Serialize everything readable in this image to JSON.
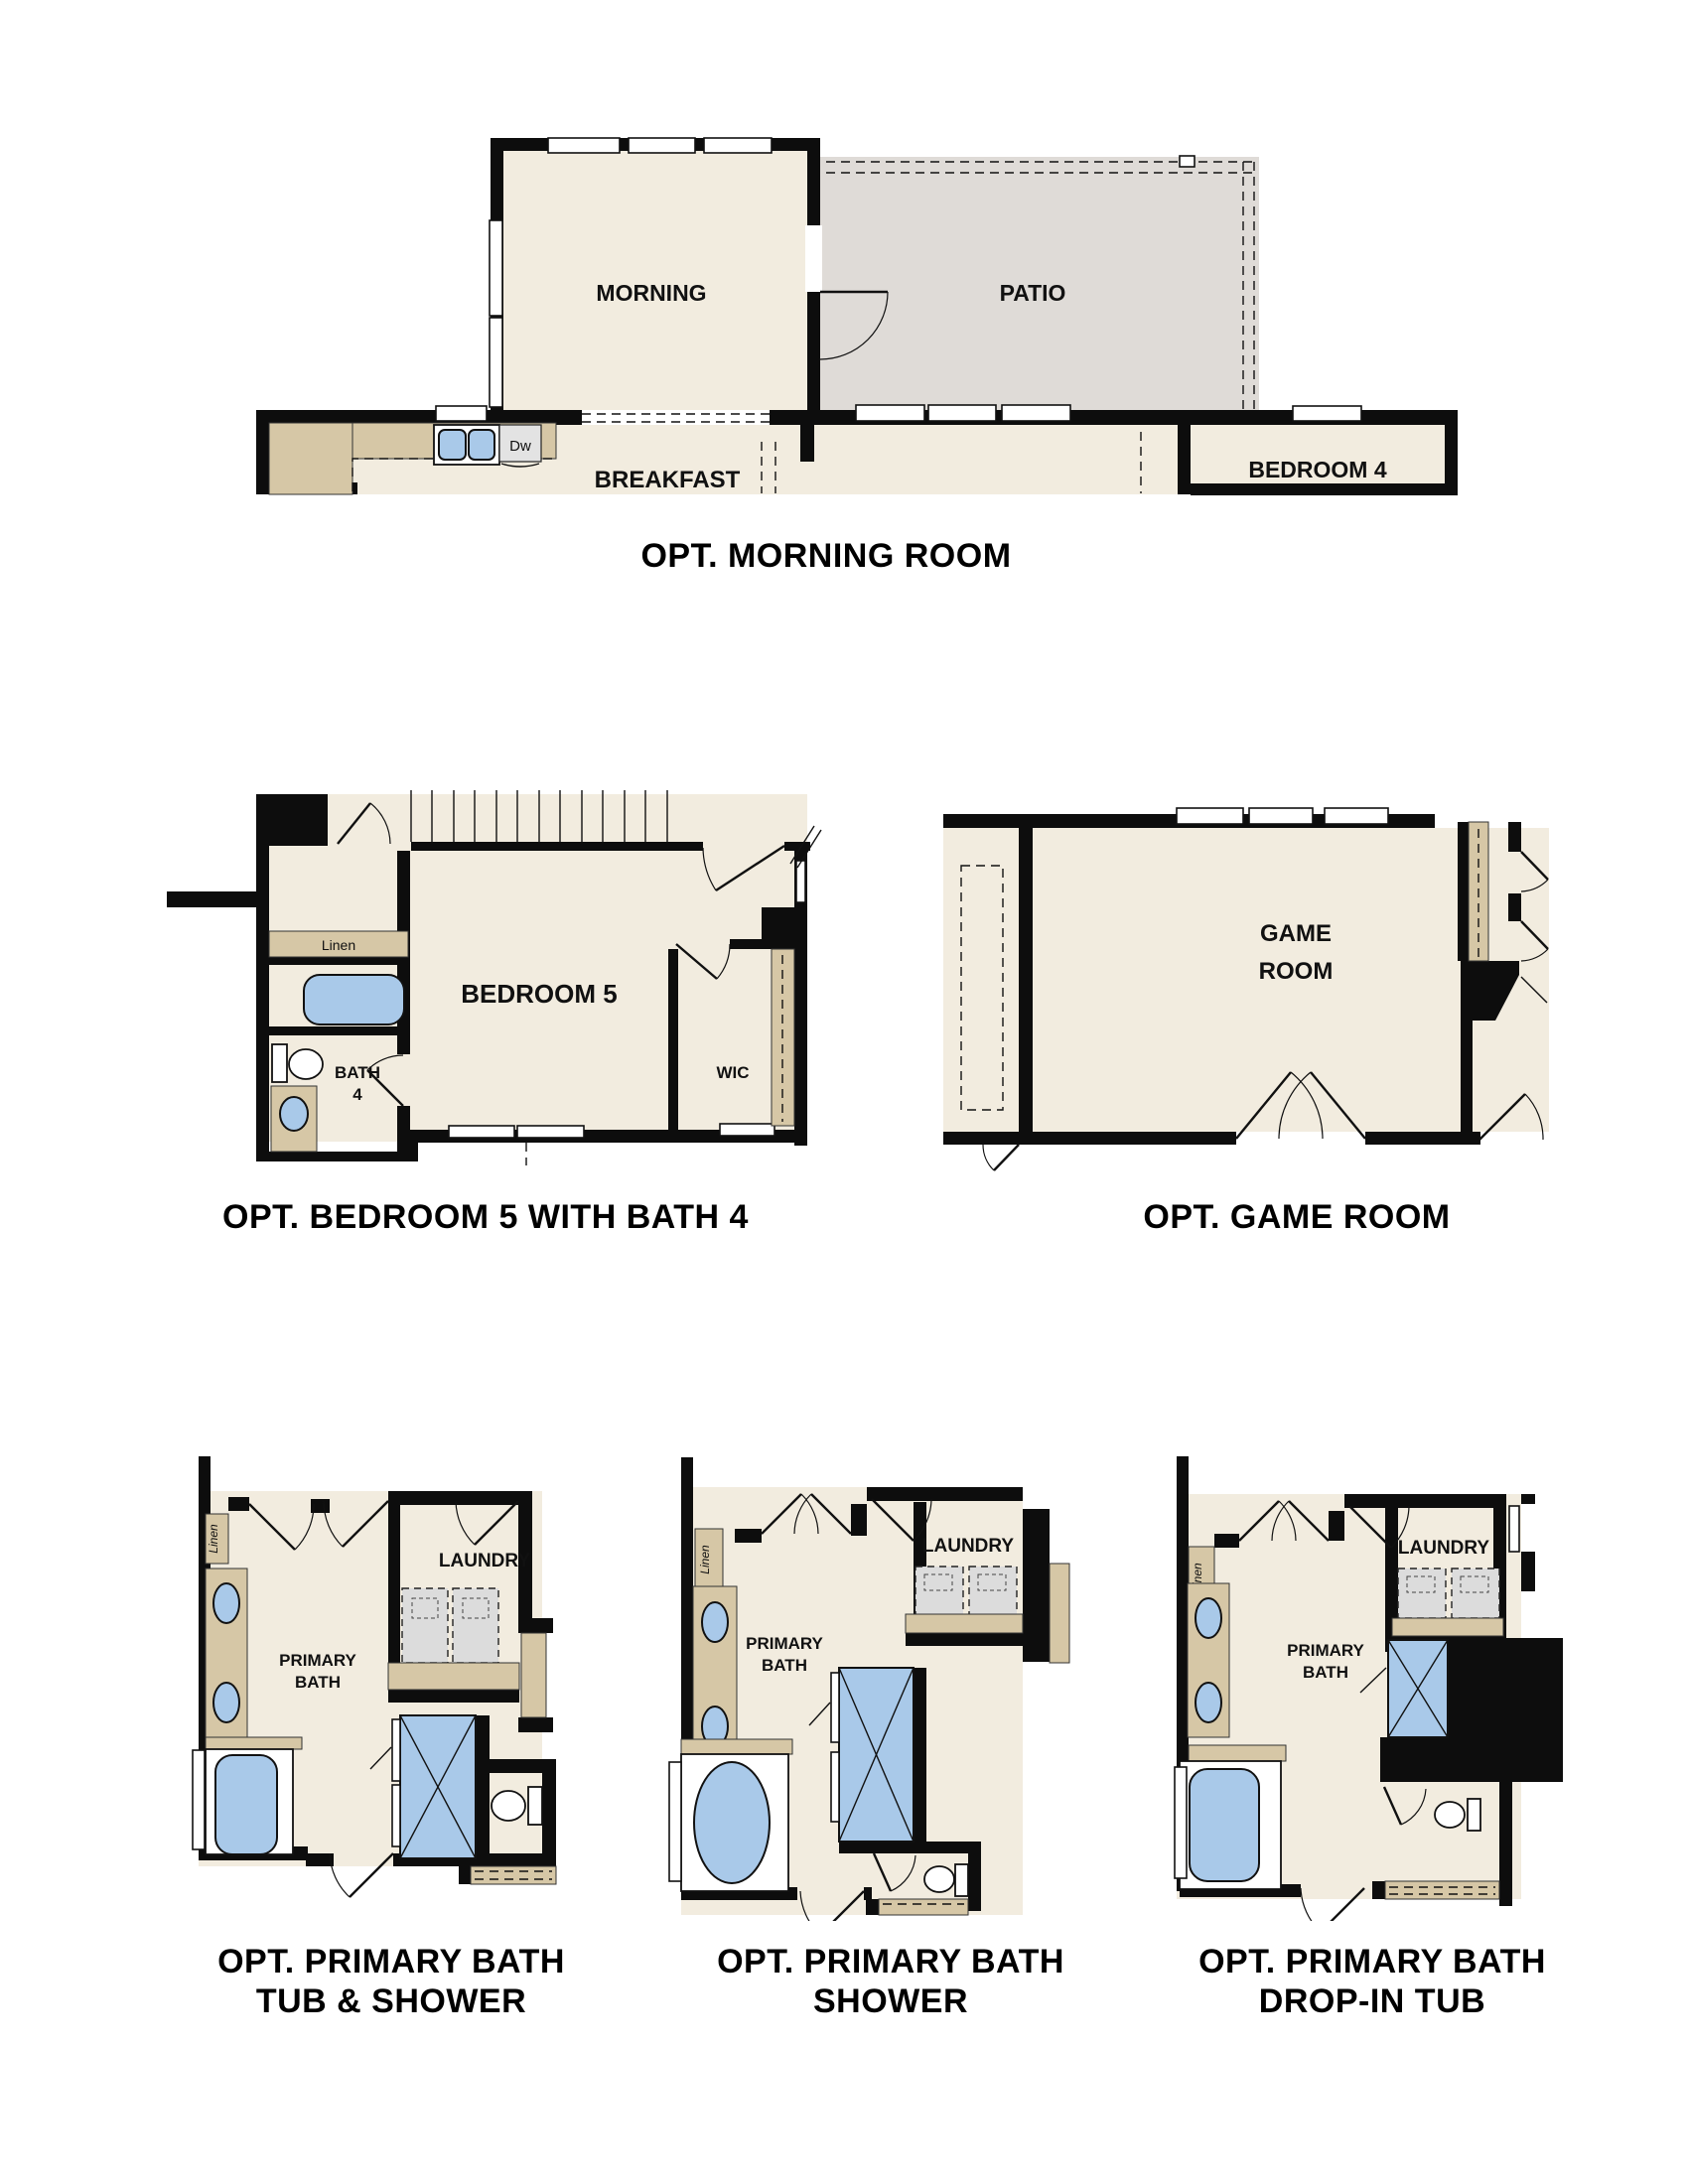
{
  "document": {
    "type": "floor-plan-options-sheet"
  },
  "colors": {
    "wall": "#0d0d0d",
    "floor_beige": "#f2ecdf",
    "patio_gray": "#dfdbd7",
    "cabinet_tan": "#d6c7a6",
    "fixture_blue": "#a9c9e9",
    "appliance_gray": "#dcdcdc",
    "background": "#ffffff"
  },
  "sections": {
    "morning_room": {
      "caption": "OPT. MORNING ROOM",
      "rooms": {
        "morning": "MORNING",
        "patio": "PATIO",
        "breakfast": "BREAKFAST",
        "bedroom4": "BEDROOM 4"
      },
      "labels": {
        "dishwasher": "Dw"
      }
    },
    "bedroom5": {
      "caption": "OPT. BEDROOM 5 WITH BATH 4",
      "rooms": {
        "bedroom5": "BEDROOM 5",
        "wic": "WIC",
        "bath_line1": "BATH",
        "bath_line2": "4"
      },
      "labels": {
        "linen": "Linen"
      }
    },
    "game_room": {
      "caption": "OPT. GAME ROOM",
      "rooms": {
        "line1": "GAME",
        "line2": "ROOM"
      }
    },
    "bath_options": {
      "shared_labels": {
        "laundry": "LAUNDRY",
        "primary_line1": "PRIMARY",
        "primary_line2": "BATH",
        "linen": "Linen"
      },
      "options": [
        {
          "caption_line1": "OPT. PRIMARY BATH",
          "caption_line2": "TUB & SHOWER"
        },
        {
          "caption_line1": "OPT. PRIMARY BATH",
          "caption_line2": "SHOWER"
        },
        {
          "caption_line1": "OPT. PRIMARY BATH",
          "caption_line2": "DROP-IN TUB"
        }
      ]
    }
  }
}
